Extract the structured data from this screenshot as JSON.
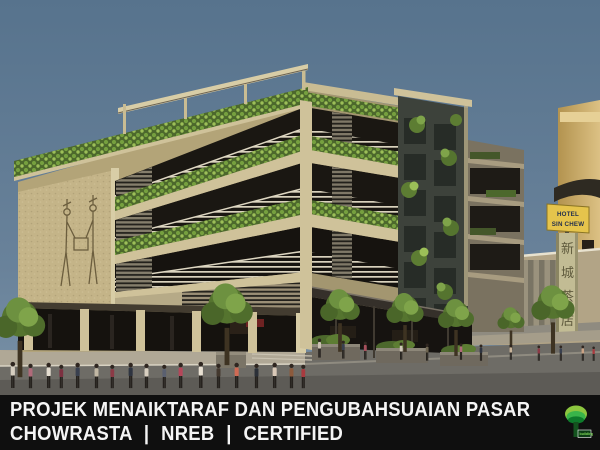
{
  "banner": {
    "line1": "PROJEK MENAIKTARAF DAN PENGUBAHSUAIAN PASAR",
    "line2": "CHOWRASTA | NREB | CERTIFIED"
  },
  "logo": {
    "name": "green-building-index-logo",
    "caption": "building"
  },
  "signs": {
    "hotel": {
      "line1": "HOTEL",
      "line2": "SIN CHEW"
    },
    "vertical_chars": [
      "新",
      "城",
      "茶",
      "店"
    ]
  },
  "colors": {
    "sky_top": "#57738d",
    "sky_bottom": "#7b93a8",
    "banner_bg": "#0f0f0f",
    "banner_text": "#f5f5f5",
    "facade_cream": "#cfc29a",
    "mural_wall_tan": "#c4b488",
    "foliage_green": "#5d7d33",
    "hotel_sign_yellow": "#e5c44c",
    "logo_green": "#39b54a",
    "canopy_dark": "#35302a"
  }
}
